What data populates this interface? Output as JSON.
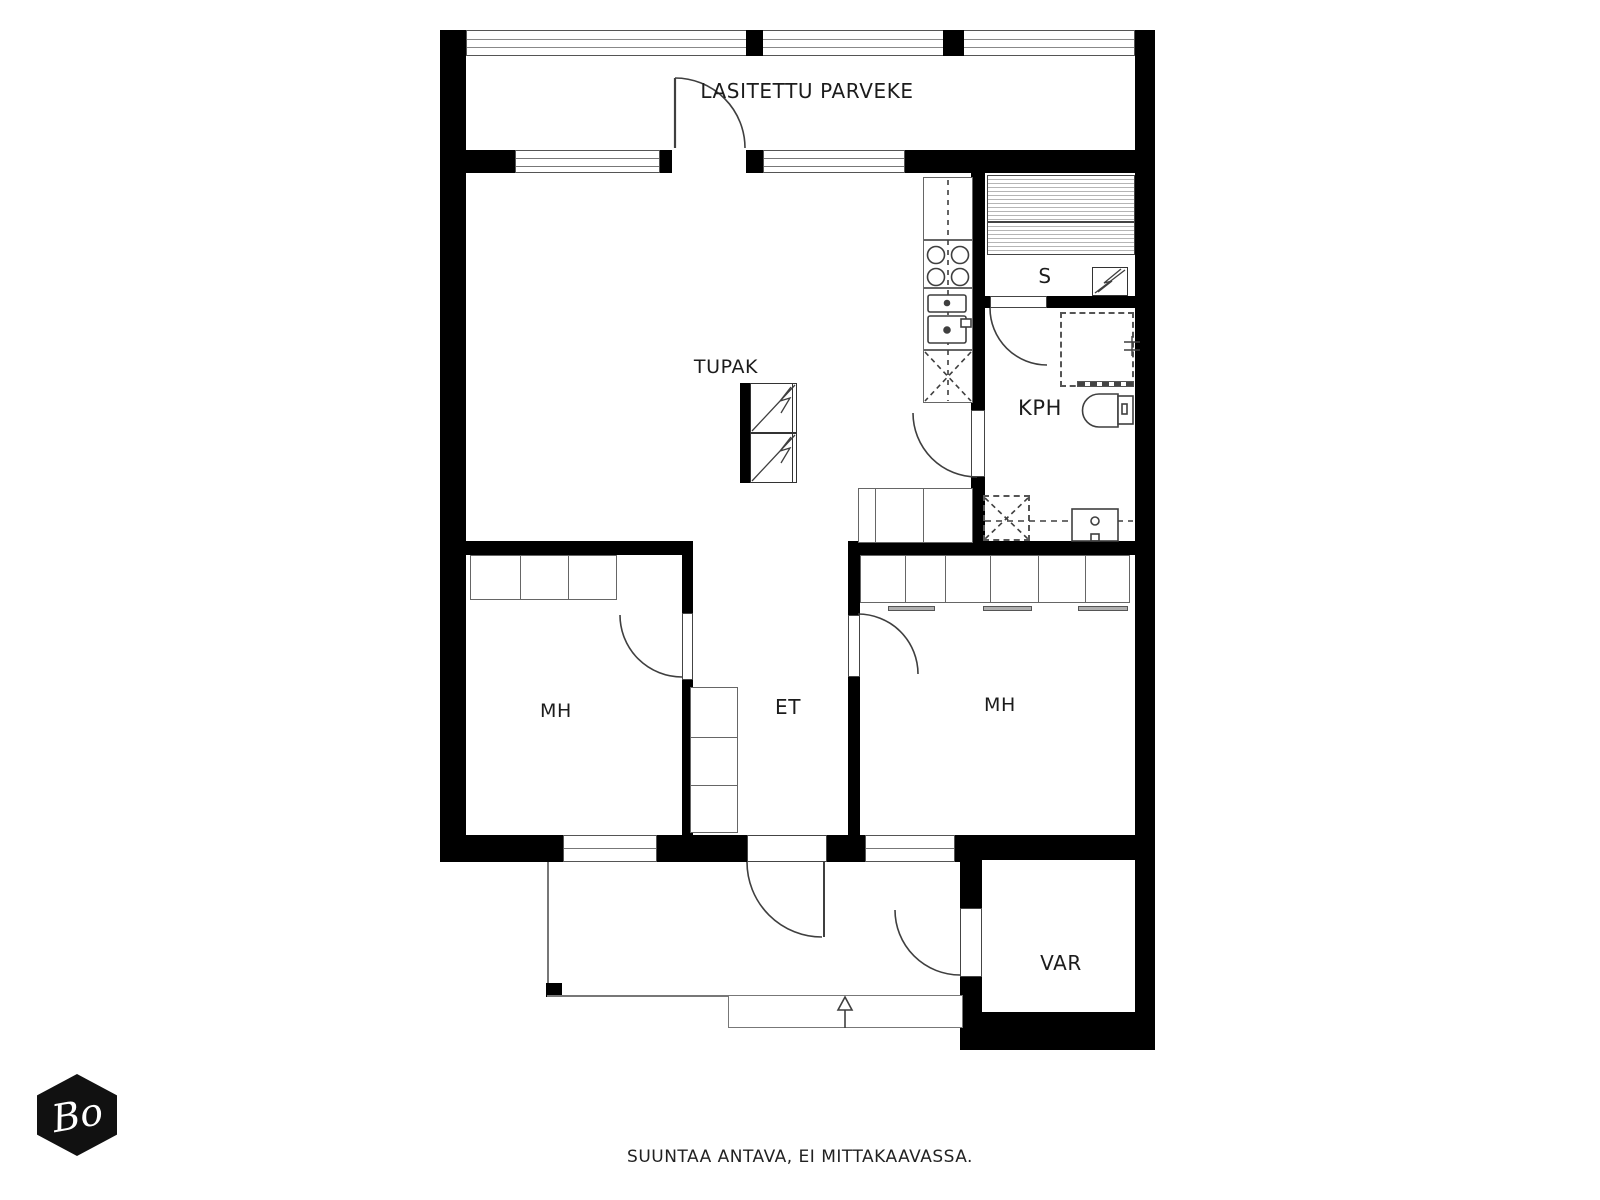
{
  "labels": {
    "balcony": "LASITETTU PARVEKE",
    "living_kitchen": "TUPAK",
    "sauna": "S",
    "bathroom": "KPH",
    "bedroom_left": "MH",
    "bedroom_right": "MH",
    "entry_hall": "ET",
    "storage": "VAR"
  },
  "footer": {
    "disclaimer": "SUUNTAA ANTAVA, EI MITTAKAAVASSA."
  },
  "logo": {
    "monogram": "Bo"
  },
  "colors": {
    "wall": "#000000",
    "line": "#3f3f3f",
    "fixture_gray": "#b0b0b0",
    "background": "#ffffff"
  }
}
